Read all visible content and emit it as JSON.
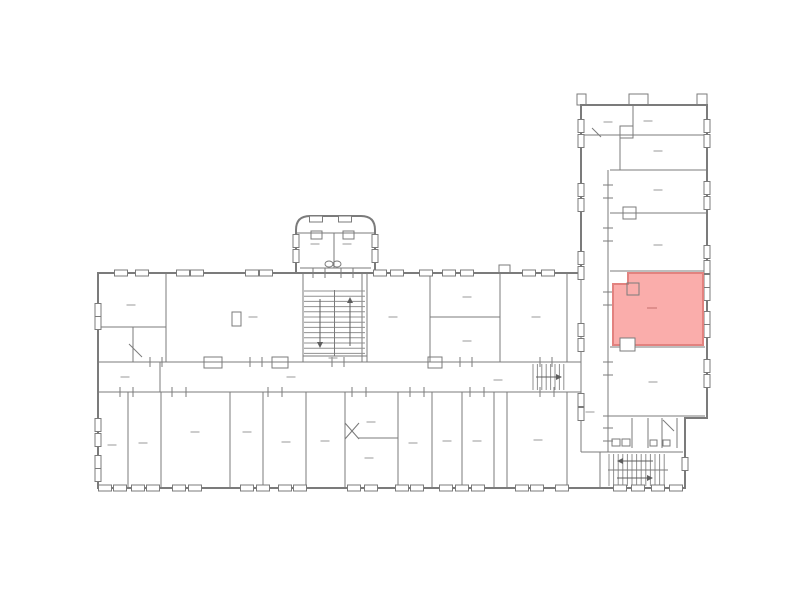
{
  "document": {
    "type": "building-floor-plan",
    "selection": {
      "selected_room": "highlighted-room",
      "selected": true
    }
  },
  "colors": {
    "background": "#ffffff",
    "wall": "#7b7b7b",
    "wall_light": "#909090",
    "label": "#9a9a9a",
    "highlight_fill": "#FAADAB",
    "highlight_stroke": "#E2827F",
    "highlight_label": "#C4706E"
  },
  "floorplan": {
    "width": 800,
    "height": 595,
    "outline": [
      "M98,273 H581 V105 H707 V418 H685 V488 H98 Z",
      "M296,273 V230 Q296,216 310,216 H361 Q375,216 375,230 V273"
    ],
    "walls": [
      [
        166,
        273,
        166,
        362
      ],
      [
        98,
        327,
        166,
        327
      ],
      [
        133,
        327,
        133,
        362
      ],
      [
        362,
        273,
        362,
        362
      ],
      [
        430,
        273,
        430,
        362
      ],
      [
        500,
        273,
        500,
        362
      ],
      [
        567,
        273,
        567,
        362
      ],
      [
        430,
        317,
        500,
        317
      ],
      [
        98,
        362,
        581,
        362
      ],
      [
        98,
        392,
        581,
        392
      ],
      [
        160,
        362,
        160,
        392
      ],
      [
        128,
        392,
        128,
        488
      ],
      [
        161,
        392,
        161,
        488
      ],
      [
        230,
        392,
        230,
        488
      ],
      [
        263,
        392,
        263,
        488
      ],
      [
        306,
        392,
        306,
        488
      ],
      [
        345,
        392,
        345,
        488
      ],
      [
        398,
        392,
        398,
        488
      ],
      [
        432,
        392,
        432,
        488
      ],
      [
        462,
        392,
        462,
        488
      ],
      [
        494,
        392,
        494,
        488
      ],
      [
        507,
        392,
        507,
        488
      ],
      [
        567,
        392,
        567,
        488
      ],
      [
        358,
        438,
        398,
        438
      ],
      [
        581,
        273,
        581,
        452
      ],
      [
        303,
        273,
        303,
        362
      ],
      [
        367,
        273,
        367,
        362
      ],
      [
        296,
        233,
        375,
        233
      ],
      [
        334,
        233,
        334,
        268
      ],
      [
        300,
        268,
        371,
        268
      ],
      [
        303,
        356,
        367,
        356
      ],
      [
        633,
        105,
        633,
        135
      ],
      [
        581,
        135,
        707,
        135
      ],
      [
        620,
        135,
        620,
        170
      ],
      [
        610,
        170,
        707,
        170
      ],
      [
        608,
        170,
        608,
        452
      ],
      [
        610,
        213,
        707,
        213
      ],
      [
        610,
        271,
        707,
        271
      ],
      [
        610,
        347,
        705,
        347
      ],
      [
        603,
        416,
        705,
        416
      ],
      [
        632,
        418,
        632,
        448
      ],
      [
        648,
        418,
        648,
        448
      ],
      [
        662,
        418,
        662,
        448
      ],
      [
        677,
        418,
        677,
        448
      ],
      [
        581,
        452,
        683,
        452
      ],
      [
        600,
        452,
        600,
        488
      ]
    ],
    "windows_h": [
      {
        "y": 273,
        "xs": [
          121,
          142,
          183,
          197,
          252,
          266,
          380,
          397,
          426,
          449,
          467,
          529,
          548
        ]
      },
      {
        "y": 219,
        "xs": [
          316,
          345
        ]
      },
      {
        "y": 488,
        "xs": [
          105,
          120,
          138,
          153,
          179,
          195,
          247,
          263,
          285,
          300,
          354,
          371,
          402,
          417,
          446,
          462,
          478,
          522,
          537,
          562,
          620,
          638,
          658,
          676
        ]
      }
    ],
    "windows_v": [
      {
        "x": 98,
        "ys": [
          310,
          323,
          425,
          440,
          462,
          475
        ]
      },
      {
        "x": 581,
        "ys": [
          126,
          141,
          190,
          205,
          258,
          273,
          330,
          345,
          400,
          414
        ]
      },
      {
        "x": 707,
        "ys": [
          126,
          141,
          188,
          203,
          252,
          267,
          281,
          294,
          318,
          331,
          366,
          381
        ]
      },
      {
        "x": 685,
        "ys": [
          464
        ]
      },
      {
        "x": 296,
        "ys": [
          241,
          256
        ]
      },
      {
        "x": 375,
        "ys": [
          241,
          256
        ]
      }
    ],
    "door_ticks_v": [
      {
        "y": 362,
        "xs": [
          150,
          162,
          250,
          262,
          332,
          344,
          460,
          472,
          540,
          552
        ]
      },
      {
        "y": 392,
        "xs": [
          120,
          133,
          172,
          186,
          268,
          282,
          352,
          366,
          410,
          424,
          470,
          484,
          540,
          554
        ]
      },
      {
        "y": 273,
        "xs": [
          313,
          325,
          341,
          353
        ]
      }
    ],
    "door_ticks_h": [
      {
        "x": 608,
        "ys": [
          185,
          198,
          228,
          241,
          292,
          305,
          362,
          375,
          428,
          441
        ]
      }
    ],
    "boxes": [
      [
        232,
        312,
        9,
        14
      ],
      [
        623,
        207,
        13,
        12
      ],
      [
        620,
        126,
        13,
        12
      ],
      [
        311,
        231,
        11,
        8
      ],
      [
        343,
        231,
        11,
        8
      ],
      [
        612,
        439,
        8,
        7
      ],
      [
        622,
        439,
        8,
        7
      ],
      [
        650,
        440,
        7,
        6
      ],
      [
        663,
        440,
        7,
        6
      ],
      [
        204,
        357,
        18,
        11
      ],
      [
        272,
        357,
        16,
        11
      ],
      [
        428,
        357,
        14,
        11
      ],
      [
        577,
        94,
        9,
        11
      ],
      [
        629,
        94,
        19,
        11
      ],
      [
        697,
        94,
        10,
        11
      ],
      [
        499,
        265,
        11,
        8
      ],
      [
        627,
        283,
        12,
        12
      ]
    ],
    "white_boxes": [
      [
        620,
        338,
        15,
        13
      ]
    ],
    "ellipses": [
      [
        329,
        264,
        4,
        3
      ],
      [
        337,
        264,
        4,
        3
      ]
    ],
    "swings": [
      [
        129,
        344,
        142,
        357
      ],
      [
        663,
        420,
        674,
        431
      ],
      [
        345,
        423,
        359,
        439
      ],
      [
        345,
        439,
        359,
        423
      ],
      [
        592,
        128,
        601,
        137
      ]
    ],
    "stairs": [
      {
        "x": 304,
        "y": 291,
        "w": 61,
        "h": 64,
        "step": 5.2,
        "riser": "h",
        "mid": "v"
      },
      {
        "x": 533,
        "y": 364,
        "w": 34,
        "h": 26,
        "step": 4.4,
        "riser": "v"
      },
      {
        "x": 609,
        "y": 454,
        "w": 58,
        "h": 32,
        "step": 4.6,
        "riser": "v",
        "mid": "h"
      }
    ],
    "arrows": [
      [
        350,
        346,
        350,
        297
      ],
      [
        320,
        299,
        320,
        348
      ],
      [
        536,
        377,
        562,
        377
      ],
      [
        653,
        461,
        617,
        461
      ],
      [
        617,
        478,
        653,
        478
      ]
    ],
    "labels": [
      [
        131,
        305
      ],
      [
        253,
        317
      ],
      [
        393,
        317
      ],
      [
        467,
        297
      ],
      [
        467,
        341
      ],
      [
        536,
        317
      ],
      [
        125,
        377
      ],
      [
        291,
        377
      ],
      [
        498,
        380
      ],
      [
        112,
        445
      ],
      [
        143,
        443
      ],
      [
        195,
        432
      ],
      [
        247,
        432
      ],
      [
        286,
        442
      ],
      [
        325,
        441
      ],
      [
        371,
        422
      ],
      [
        369,
        458
      ],
      [
        413,
        443
      ],
      [
        447,
        441
      ],
      [
        477,
        441
      ],
      [
        538,
        440
      ],
      [
        333,
        358
      ],
      [
        315,
        244
      ],
      [
        347,
        244
      ],
      [
        608,
        122
      ],
      [
        648,
        121
      ],
      [
        658,
        151
      ],
      [
        658,
        190
      ],
      [
        658,
        245
      ],
      [
        653,
        382
      ],
      [
        590,
        412
      ]
    ],
    "highlight": {
      "points": "613,284 628,284 628,273 703,273 703,345 613,345",
      "label": [
        652,
        308
      ]
    }
  }
}
